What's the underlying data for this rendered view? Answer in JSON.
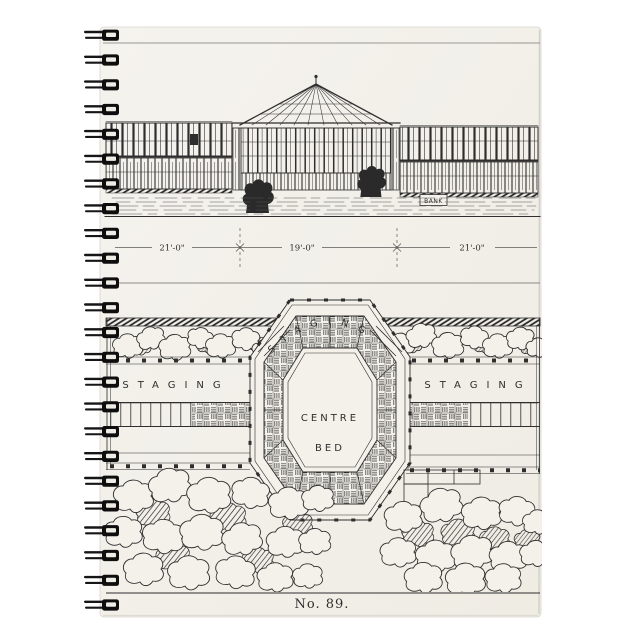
{
  "notebook": {
    "caption": "No. 89.",
    "elevation": {
      "dim_left": "21'-0\"",
      "dim_center": "19'-0\"",
      "dim_right": "21'-0\"",
      "bank_sign": "BANK"
    },
    "plan": {
      "staging_arc": "STAGING",
      "staging_left": "STAGING",
      "staging_right": "STAGING",
      "centre_bed_line1": "CENTRE",
      "centre_bed_line2": "BED"
    },
    "colors": {
      "cover": "#f3f1ea",
      "ink": "#2e2e2e",
      "wire": "#141414",
      "background": "#ffffff"
    }
  }
}
